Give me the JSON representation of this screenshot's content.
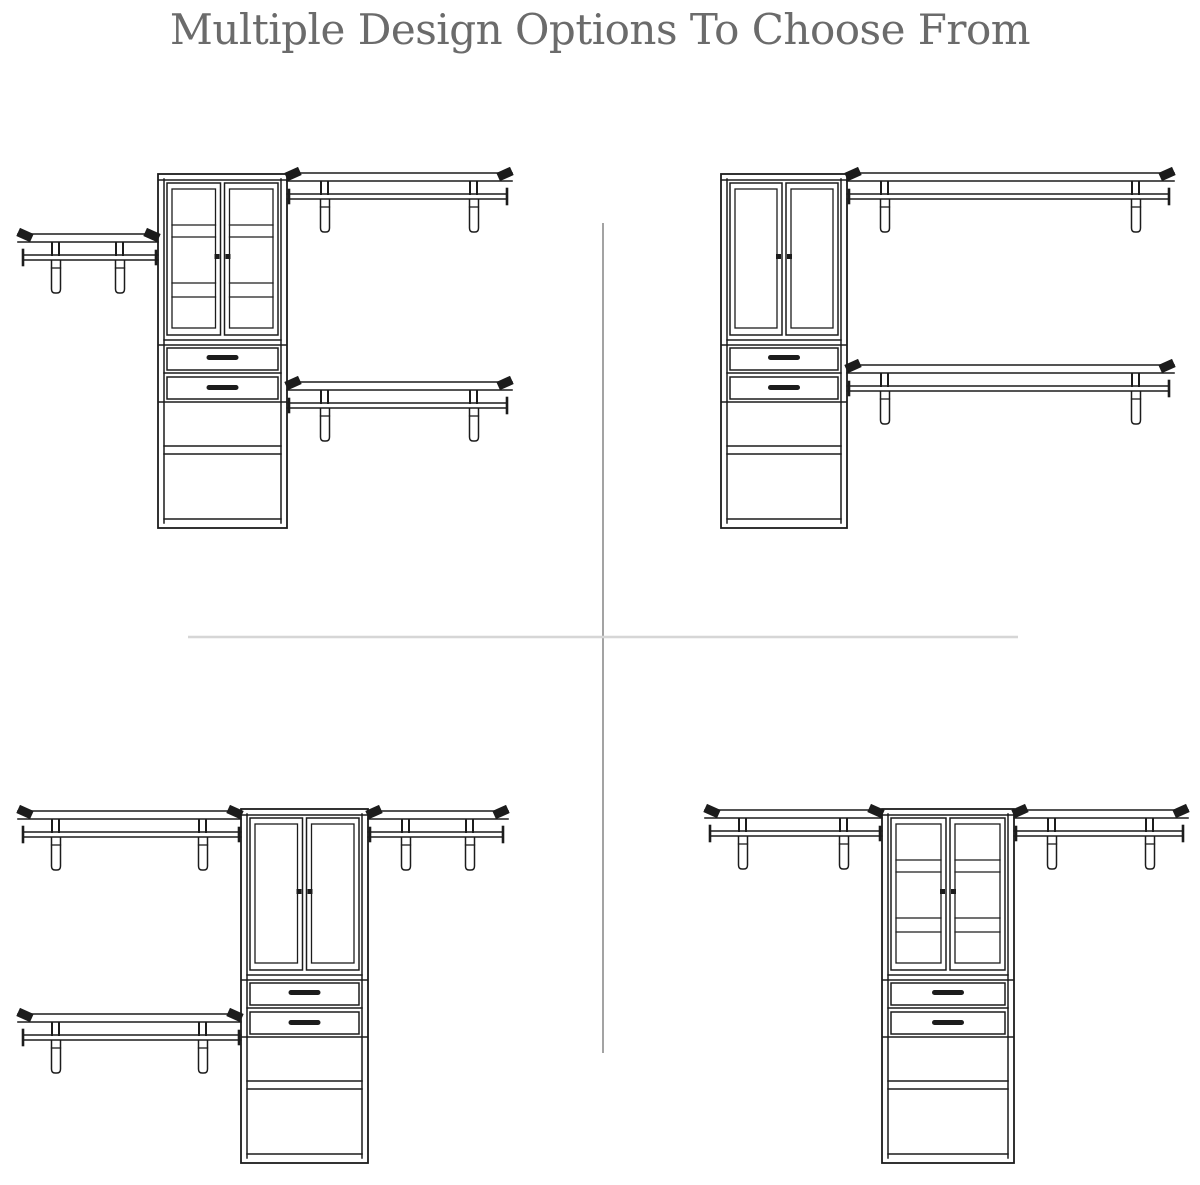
{
  "title": "Multiple Design Options To Choose From",
  "colors": {
    "bg": "#ffffff",
    "title": "#6b6b6b",
    "line": "#1c1c1c",
    "divider_v": "#a3a3a3",
    "divider_h": "#d6d6d6"
  },
  "canvas": {
    "width": 1200,
    "height": 1185
  },
  "dividers": {
    "vertical": {
      "x": 603,
      "y1": 223,
      "y2": 1053
    },
    "horizontal": {
      "y": 637,
      "x1": 188,
      "x2": 1018
    }
  },
  "designs": [
    {
      "id": "design-option-top-left",
      "position": "top-left",
      "doors": "glass-3-pane",
      "tower": {
        "x": 158,
        "y": 174,
        "w": 129,
        "h": 354
      },
      "shelves": [
        {
          "side": "right",
          "y": 173,
          "len": 225
        },
        {
          "side": "right",
          "y": 382,
          "len": 225
        },
        {
          "side": "left",
          "y": 234,
          "len": 140
        }
      ]
    },
    {
      "id": "design-option-top-right",
      "position": "top-right",
      "doors": "plain-panel",
      "tower": {
        "x": 721,
        "y": 174,
        "w": 126,
        "h": 354
      },
      "shelves": [
        {
          "side": "right",
          "y": 173,
          "len": 327
        },
        {
          "side": "right",
          "y": 365,
          "len": 327
        }
      ]
    },
    {
      "id": "design-option-bottom-left",
      "position": "bottom-left",
      "doors": "plain-panel",
      "tower": {
        "x": 241,
        "y": 809,
        "w": 127,
        "h": 354
      },
      "shelves": [
        {
          "side": "left",
          "y": 811,
          "len": 223
        },
        {
          "side": "right",
          "y": 811,
          "len": 140
        },
        {
          "side": "left",
          "y": 1014,
          "len": 223
        }
      ]
    },
    {
      "id": "design-option-bottom-right",
      "position": "bottom-right",
      "doors": "glass-3-pane",
      "tower": {
        "x": 882,
        "y": 809,
        "w": 132,
        "h": 354
      },
      "shelves": [
        {
          "side": "left",
          "y": 810,
          "len": 177
        },
        {
          "side": "right",
          "y": 810,
          "len": 174
        }
      ]
    }
  ]
}
